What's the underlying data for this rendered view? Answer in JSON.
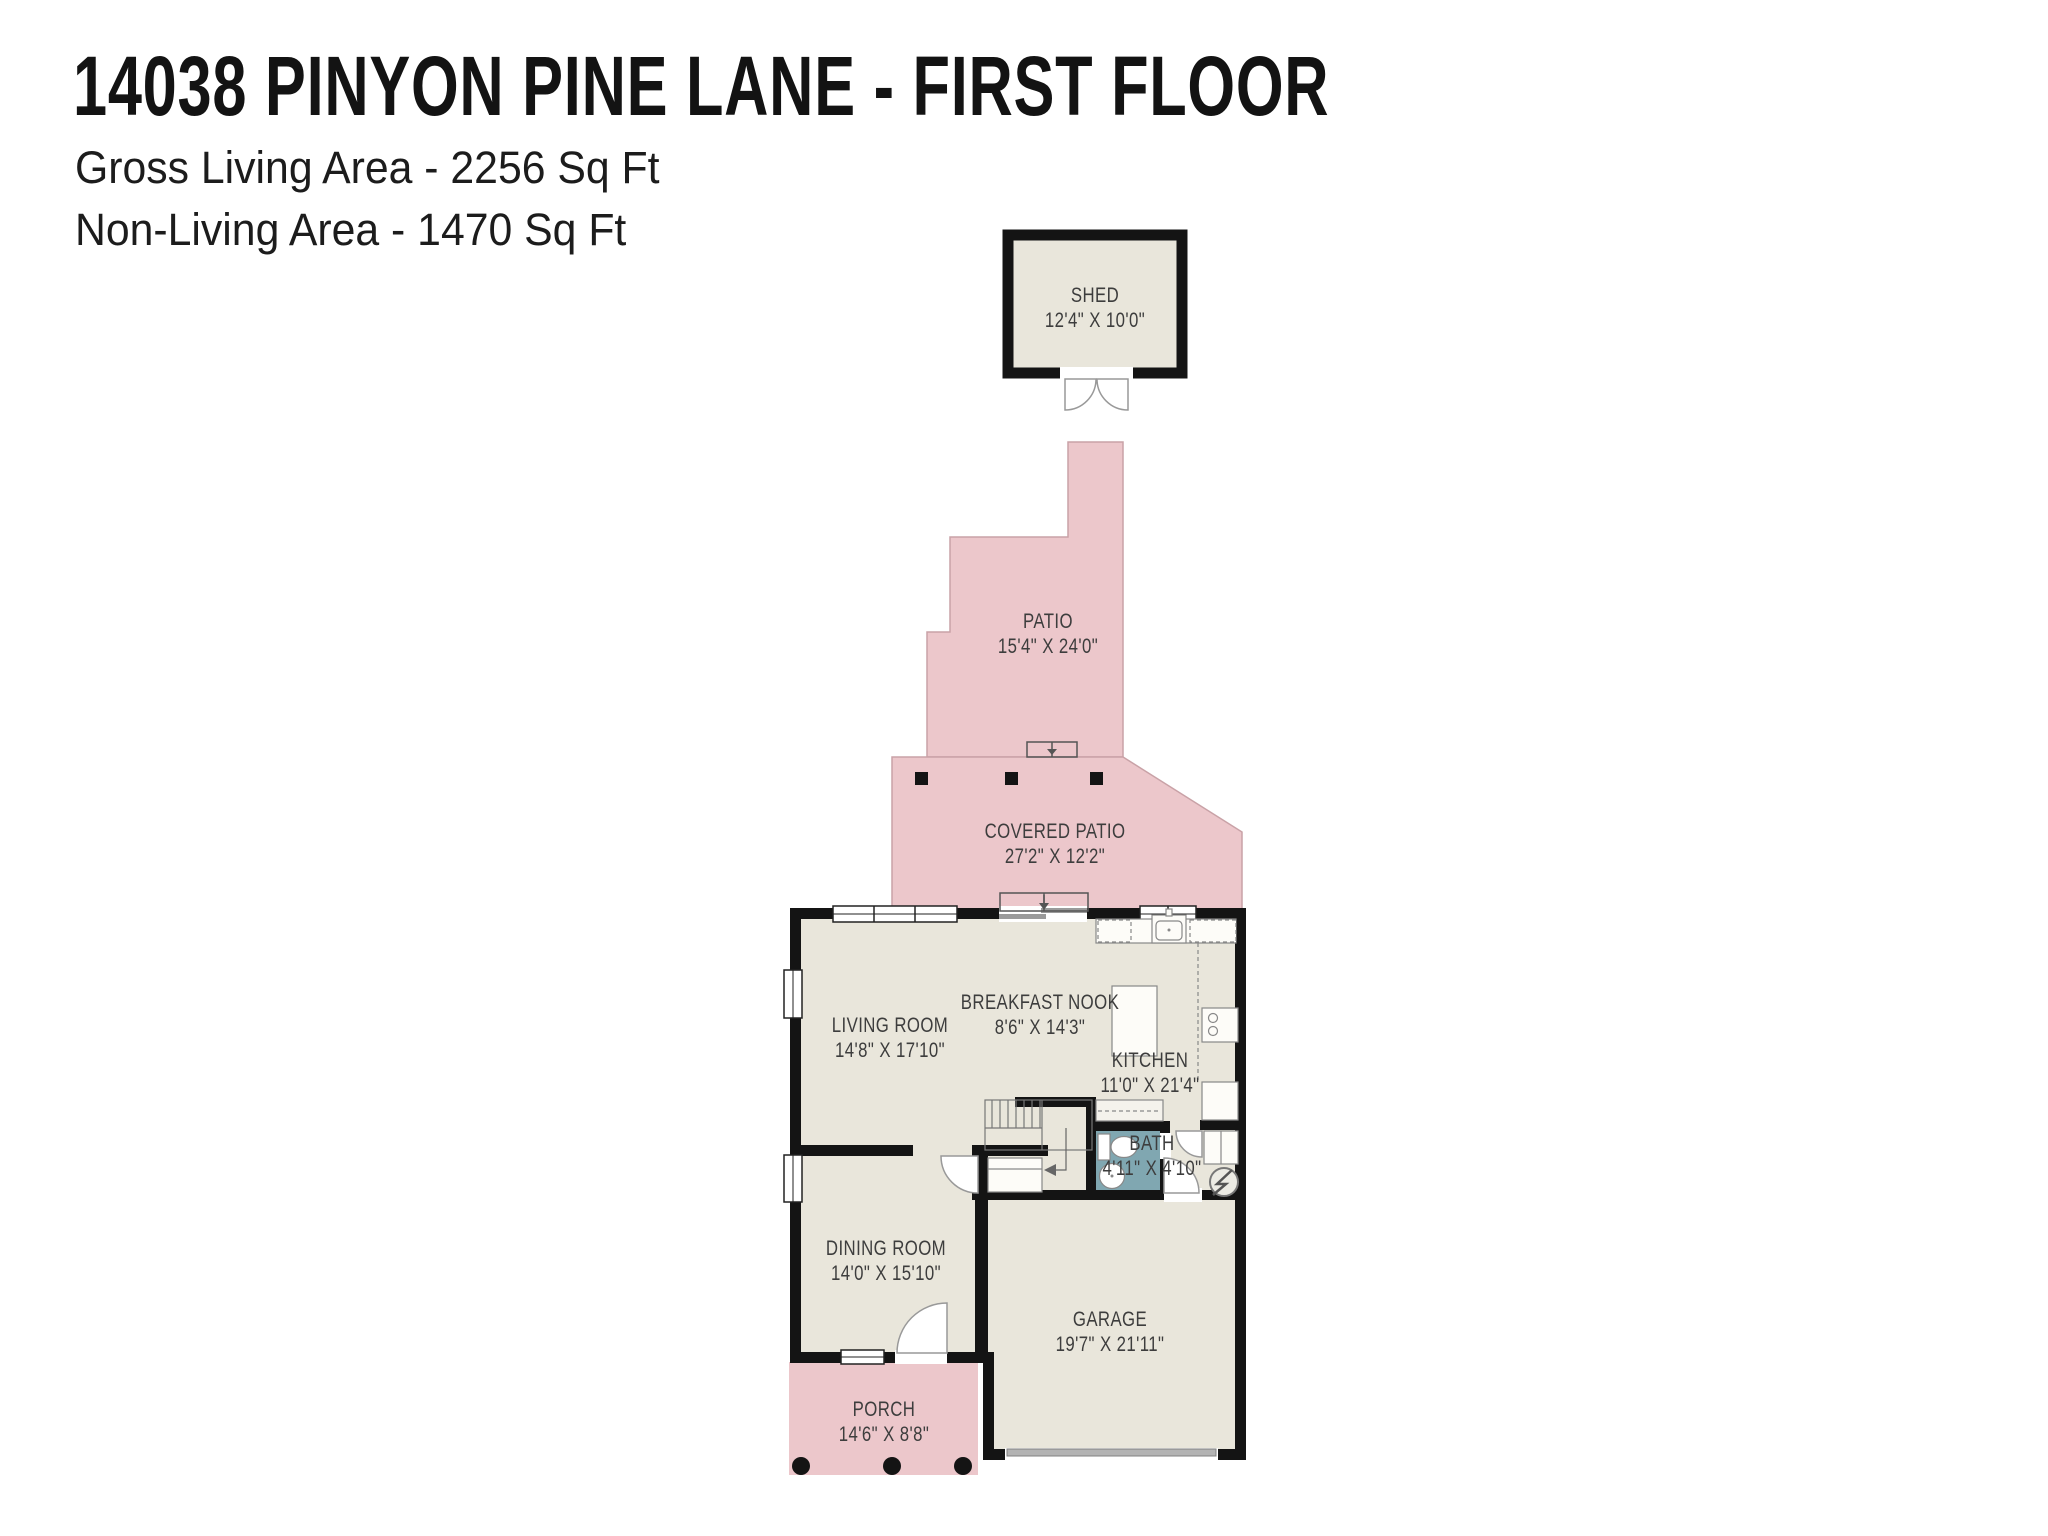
{
  "header": {
    "title": "14038 PINYON PINE LANE - FIRST FLOOR",
    "gross_living_area": "Gross Living Area - 2256 Sq Ft",
    "non_living_area": "Non-Living Area - 1470 Sq Ft"
  },
  "rooms": {
    "shed": {
      "label": "SHED",
      "dims": "12'4\" X 10'0\""
    },
    "patio": {
      "label": "PATIO",
      "dims": "15'4\" X 24'0\""
    },
    "covered_patio": {
      "label": "COVERED PATIO",
      "dims": "27'2\" X 12'2\""
    },
    "living_room": {
      "label": "LIVING ROOM",
      "dims": "14'8\" X 17'10\""
    },
    "breakfast_nook": {
      "label": "BREAKFAST NOOK",
      "dims": "8'6\" X 14'3\""
    },
    "kitchen": {
      "label": "KITCHEN",
      "dims": "11'0\" X 21'4\""
    },
    "bath": {
      "label": "BATH",
      "dims": "4'11\" X 4'10\""
    },
    "dining_room": {
      "label": "DINING ROOM",
      "dims": "14'0\" X 15'10\""
    },
    "garage": {
      "label": "GARAGE",
      "dims": "19'7\" X 21'11\""
    },
    "porch": {
      "label": "PORCH",
      "dims": "14'6\" X 8'8\""
    }
  },
  "colors": {
    "outdoor_area_pink": "#ecc7cb",
    "interior_beige": "#e9e6db",
    "bathroom_teal": "#80a7b1",
    "wall_black": "#141414",
    "label_text": "#3d3d3d"
  }
}
